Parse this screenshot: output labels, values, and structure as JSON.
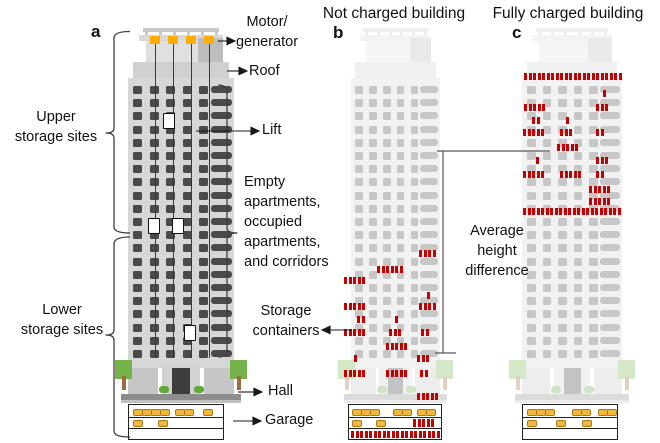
{
  "titles": {
    "panel_b_title": "Not charged building",
    "panel_c_title": "Fully charged building"
  },
  "panel_labels": {
    "a": "a",
    "b": "b",
    "c": "c"
  },
  "annotations": {
    "motor_generator": "Motor/\ngenerator",
    "roof": "Roof",
    "upper_storage": "Upper\nstorage sites",
    "lift": "Lift",
    "apartments": "Empty\napartments,\noccupied\napartments,\nand corridors",
    "lower_storage": "Lower\nstorage sites",
    "storage_containers": "Storage\ncontainers",
    "hall": "Hall",
    "garage": "Garage",
    "avg_height": "Average\nheight\ndifference"
  },
  "colors": {
    "container_red": "#c40000",
    "motor_orange": "#ffad00",
    "facade": "#d7d7d7",
    "window": "#4a4a4a",
    "car_yellow": "#f2b83c",
    "tree_green": "#74b24a",
    "bush_green": "#63a83f",
    "trunk_brown": "#9c6b40",
    "line_dark": "#2a2a2a",
    "structure_fade": 0.3
  },
  "buildings": {
    "a": {
      "x": 128,
      "w": 106,
      "faded": false,
      "motor_blocks": [
        150,
        168,
        186,
        204
      ],
      "cables": [
        155,
        173,
        191,
        209
      ],
      "lift_cars": [
        [
          163,
          113
        ],
        [
          148,
          218
        ],
        [
          172,
          218
        ],
        [
          184,
          325
        ]
      ],
      "containers": []
    },
    "b": {
      "x": 351,
      "w": 89,
      "faded": true,
      "containers": [
        {
          "y": 250,
          "groups": [
            {
              "x": 419,
              "n": 4
            }
          ]
        },
        {
          "y": 266,
          "groups": [
            {
              "x": 377,
              "n": 6
            }
          ]
        },
        {
          "y": 277,
          "groups": [
            {
              "x": 344,
              "n": 5
            }
          ]
        },
        {
          "y": 292,
          "groups": [
            {
              "x": 427,
              "n": 1
            }
          ]
        },
        {
          "y": 303,
          "groups": [
            {
              "x": 344,
              "n": 5
            },
            {
              "x": 419,
              "n": 4
            }
          ]
        },
        {
          "y": 316,
          "groups": [
            {
              "x": 357,
              "n": 2
            },
            {
              "x": 395,
              "n": 1
            }
          ]
        },
        {
          "y": 329,
          "groups": [
            {
              "x": 344,
              "n": 5
            },
            {
              "x": 389,
              "n": 3
            },
            {
              "x": 421,
              "n": 2
            }
          ]
        },
        {
          "y": 343,
          "groups": [
            {
              "x": 386,
              "n": 5
            }
          ]
        },
        {
          "y": 355,
          "groups": [
            {
              "x": 354,
              "n": 1
            },
            {
              "x": 417,
              "n": 3
            }
          ]
        },
        {
          "y": 370,
          "groups": [
            {
              "x": 344,
              "n": 5
            },
            {
              "x": 386,
              "n": 5
            },
            {
              "x": 420,
              "n": 2
            }
          ]
        },
        {
          "y": 393,
          "groups": [
            {
              "x": 417,
              "n": 5
            }
          ]
        }
      ]
    },
    "c": {
      "x": 522,
      "w": 100,
      "faded": true,
      "containers": [
        {
          "y": 73,
          "groups": [
            {
              "x": 524,
              "n": 22
            }
          ]
        },
        {
          "y": 90,
          "groups": [
            {
              "x": 603,
              "n": 1
            }
          ]
        },
        {
          "y": 104,
          "groups": [
            {
              "x": 524,
              "n": 5
            },
            {
              "x": 596,
              "n": 3
            }
          ]
        },
        {
          "y": 117,
          "groups": [
            {
              "x": 532,
              "n": 2
            },
            {
              "x": 566,
              "n": 1
            }
          ]
        },
        {
          "y": 129,
          "groups": [
            {
              "x": 523,
              "n": 5
            },
            {
              "x": 560,
              "n": 3
            },
            {
              "x": 596,
              "n": 2
            }
          ]
        },
        {
          "y": 144,
          "groups": [
            {
              "x": 557,
              "n": 5
            }
          ]
        },
        {
          "y": 157,
          "groups": [
            {
              "x": 536,
              "n": 1
            },
            {
              "x": 596,
              "n": 3
            }
          ]
        },
        {
          "y": 171,
          "groups": [
            {
              "x": 523,
              "n": 5
            },
            {
              "x": 560,
              "n": 5
            },
            {
              "x": 596,
              "n": 2
            }
          ]
        },
        {
          "y": 186,
          "groups": [
            {
              "x": 589,
              "n": 5
            }
          ]
        },
        {
          "y": 198,
          "groups": [
            {
              "x": 589,
              "n": 5
            }
          ]
        },
        {
          "y": 208,
          "groups": [
            {
              "x": 523,
              "n": 22
            }
          ]
        }
      ]
    }
  },
  "garages": {
    "a": {
      "x": 128,
      "y": 404,
      "w": 94,
      "h": 34,
      "rows": [
        {
          "cars": [
            4,
            13,
            22,
            31,
            46,
            55,
            74
          ]
        },
        {
          "cars": [
            4,
            29
          ]
        },
        {}
      ]
    },
    "b": {
      "x": 348,
      "y": 404,
      "w": 92,
      "h": 34,
      "rows": [
        {
          "cars": [
            3,
            12,
            21,
            44,
            53,
            68,
            77
          ]
        },
        {
          "cars": [
            3,
            27
          ],
          "red": [
            {
              "x": 64,
              "n": 5
            }
          ]
        },
        {
          "red": [
            {
              "x": 2,
              "n": 20
            }
          ]
        }
      ]
    },
    "c": {
      "x": 522,
      "y": 404,
      "w": 94,
      "h": 34,
      "rows": [
        {
          "cars": [
            4,
            13,
            22,
            49,
            58,
            75,
            84
          ]
        },
        {
          "cars": [
            4,
            33,
            59
          ]
        },
        {}
      ]
    }
  }
}
